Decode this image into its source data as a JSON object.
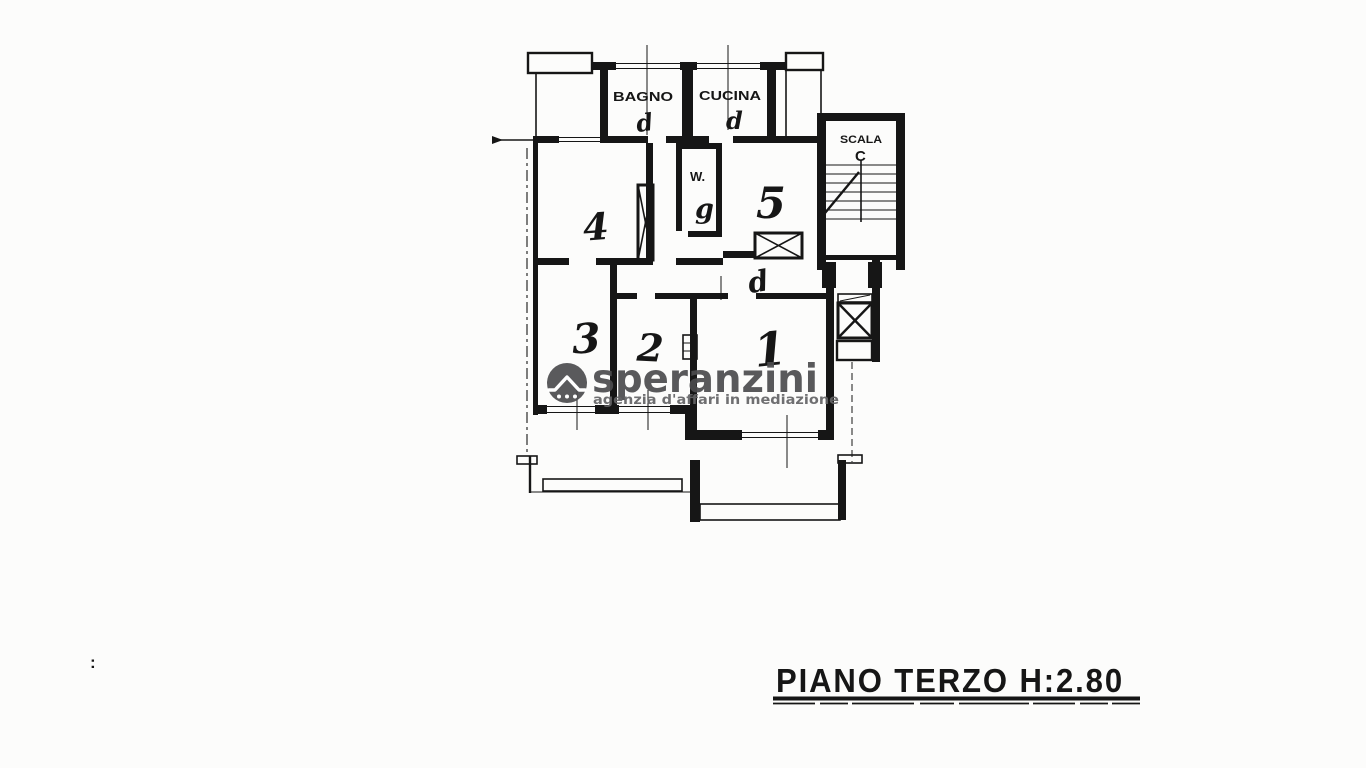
{
  "colors": {
    "ink": "#161616",
    "paper": "#fcfcfb",
    "watermark": "#4c4c4e",
    "watermark_light": "#646466"
  },
  "floorplan": {
    "labels": {
      "bathroom": "BAGNO",
      "kitchen": "CUCINA",
      "stairs_line1": "SCALA",
      "stairs_line2": "C",
      "wc_label": "W.",
      "wc_note": "g"
    },
    "room_numbers": {
      "r1": "1",
      "r2": "2",
      "r3": "3",
      "r4": "4",
      "r5": "5"
    },
    "handwritten_marks": {
      "bagno_door": "d",
      "cucina_door": "d",
      "hall_door": "d",
      "stray_mark": ":"
    }
  },
  "watermark": {
    "brand": "speranzini",
    "tagline": "agenzia d'affari in mediazione",
    "logo": "house-roof-icon"
  },
  "caption": {
    "text": "PIANO TERZO H:2.80"
  }
}
